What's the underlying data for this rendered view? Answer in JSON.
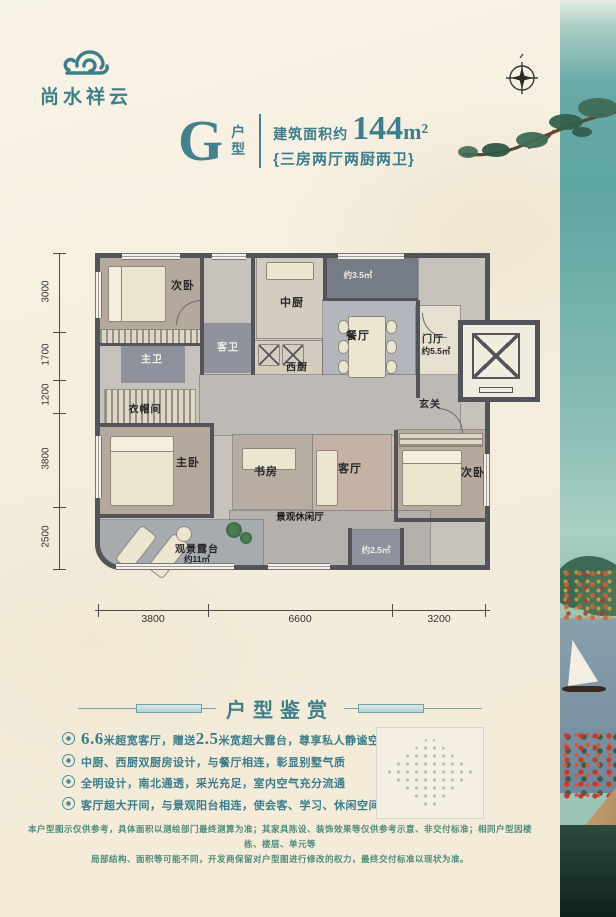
{
  "brand": {
    "logo_text": "尚水祥云"
  },
  "header": {
    "type_letter": "G",
    "type_label_1": "户",
    "type_label_2": "型",
    "area_prefix": "建筑面积约",
    "area_value": "144",
    "area_unit": "m²",
    "layout_desc": "{三房两厅两厨两卫}"
  },
  "plan": {
    "rooms": {
      "bedroom_tl": "次卧",
      "mid_kitchen": "中厨",
      "balcony_top_area": "约3.5㎡",
      "dining": "餐厅",
      "foyer": "门厅",
      "foyer_area": "约5.5㎡",
      "guest_bath": "客卫",
      "west_kitchen": "西厨",
      "master_bath": "主卫",
      "cloakroom": "衣帽间",
      "hallway": "玄关",
      "master_bedroom": "主卧",
      "study": "书房",
      "living": "客厅",
      "bedroom_r": "次卧",
      "leisure_hall": "景观休闲厅",
      "terrace": "观景露台",
      "terrace_area": "约11㎡",
      "balcony_small_area": "约2.5㎡"
    },
    "dims_left": [
      "3000",
      "1700",
      "1200",
      "3800",
      "2500"
    ],
    "dims_bottom": [
      "3800",
      "6600",
      "3200"
    ]
  },
  "appreciation": {
    "title": "户型鉴赏",
    "bullet1_num1": "6.6",
    "bullet1_t1": "米超宽客厅，赠送",
    "bullet1_num2": "2.5",
    "bullet1_t2": "米宽超大露台，尊享私人静谧空间",
    "bullet2": "中厨、西厨双厨房设计，与餐厅相连，彰显别墅气质",
    "bullet3": "全明设计，南北通透，采光充足，室内空气充分流通",
    "bullet4": "客厅超大开间，与景观阳台相连，使会客、学习、休闲空间融为一体"
  },
  "disclaimer": {
    "line1": "本户型图示仅供参考，具体面积以测绘部门最终测算为准；其家具陈设、装饰效果等仅供参考示意、非交付标准；相同户型因楼栋、楼层、单元等",
    "line2": "局部结构、面积等可能不同，开发商保留对户型图进行修改的权力，最终交付标准以现状为准。"
  },
  "colors": {
    "accent": "#3e7d8b",
    "strip_teal": "#5fa5a2",
    "wall": "#53535a"
  }
}
